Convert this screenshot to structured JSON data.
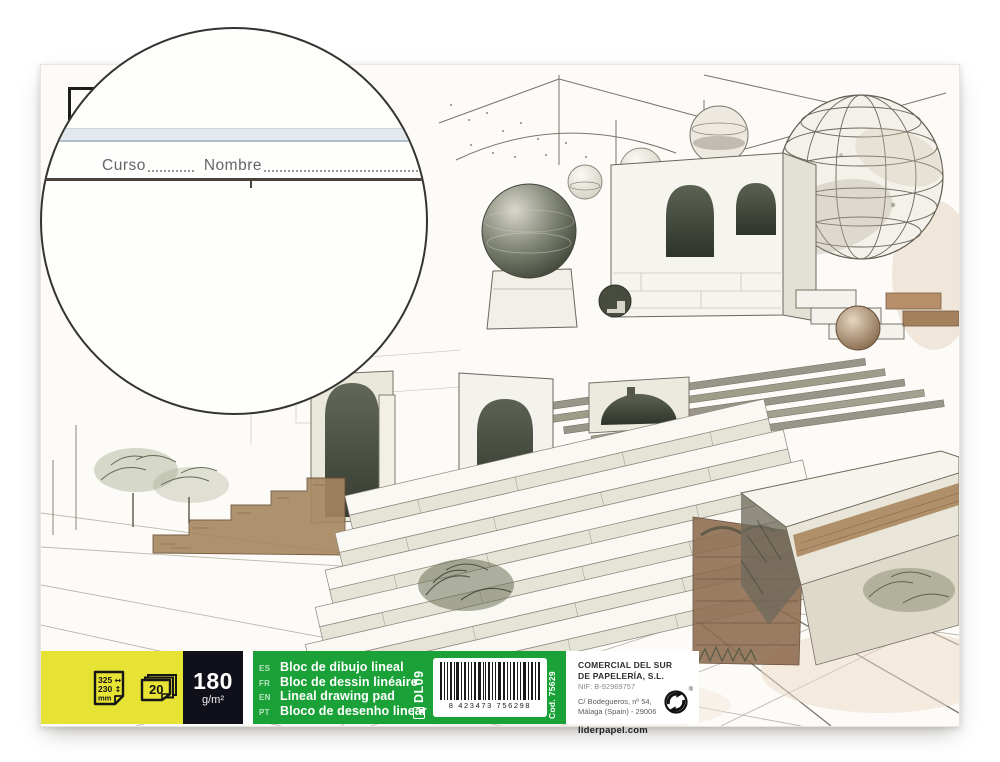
{
  "product": {
    "name": "Lineal drawing pad",
    "magnifier": {
      "curso_label": "Curso",
      "nombre_label": "Nombre"
    },
    "specs": {
      "size_width": "325",
      "size_height": "230",
      "size_unit": "mm",
      "width_arrow": "↔",
      "height_arrow": "↕",
      "sheets": "20",
      "weight_value": "180",
      "weight_unit": "g/m²"
    },
    "languages": [
      {
        "code": "ES",
        "label": "Bloc de dibujo lineal"
      },
      {
        "code": "FR",
        "label": "Bloc de dessin linéaire"
      },
      {
        "code": "EN",
        "label": "Lineal drawing pad"
      },
      {
        "code": "PT",
        "label": "Bloco de desenho linear"
      }
    ],
    "ref_code": "DL09",
    "barcode_digits": "8 423473 756298",
    "cod_label": "Cod. 75629",
    "company": {
      "name_line1": "COMERCIAL DEL SUR",
      "name_line2": "DE PAPELERÍA, S.L.",
      "nif": "NIF: B-92969757",
      "address_line1": "C/ Bodegueros, nº 54,",
      "address_line2": "Málaga (Spain) - 29006",
      "website": "liderpapel.com",
      "reg_mark": "®"
    },
    "colors": {
      "banner_yellow": "#e7e334",
      "banner_black": "#10101a",
      "banner_green": "#1aa238",
      "panel_white": "#ffffff",
      "header_band_blue": "#e2e8ee"
    }
  }
}
